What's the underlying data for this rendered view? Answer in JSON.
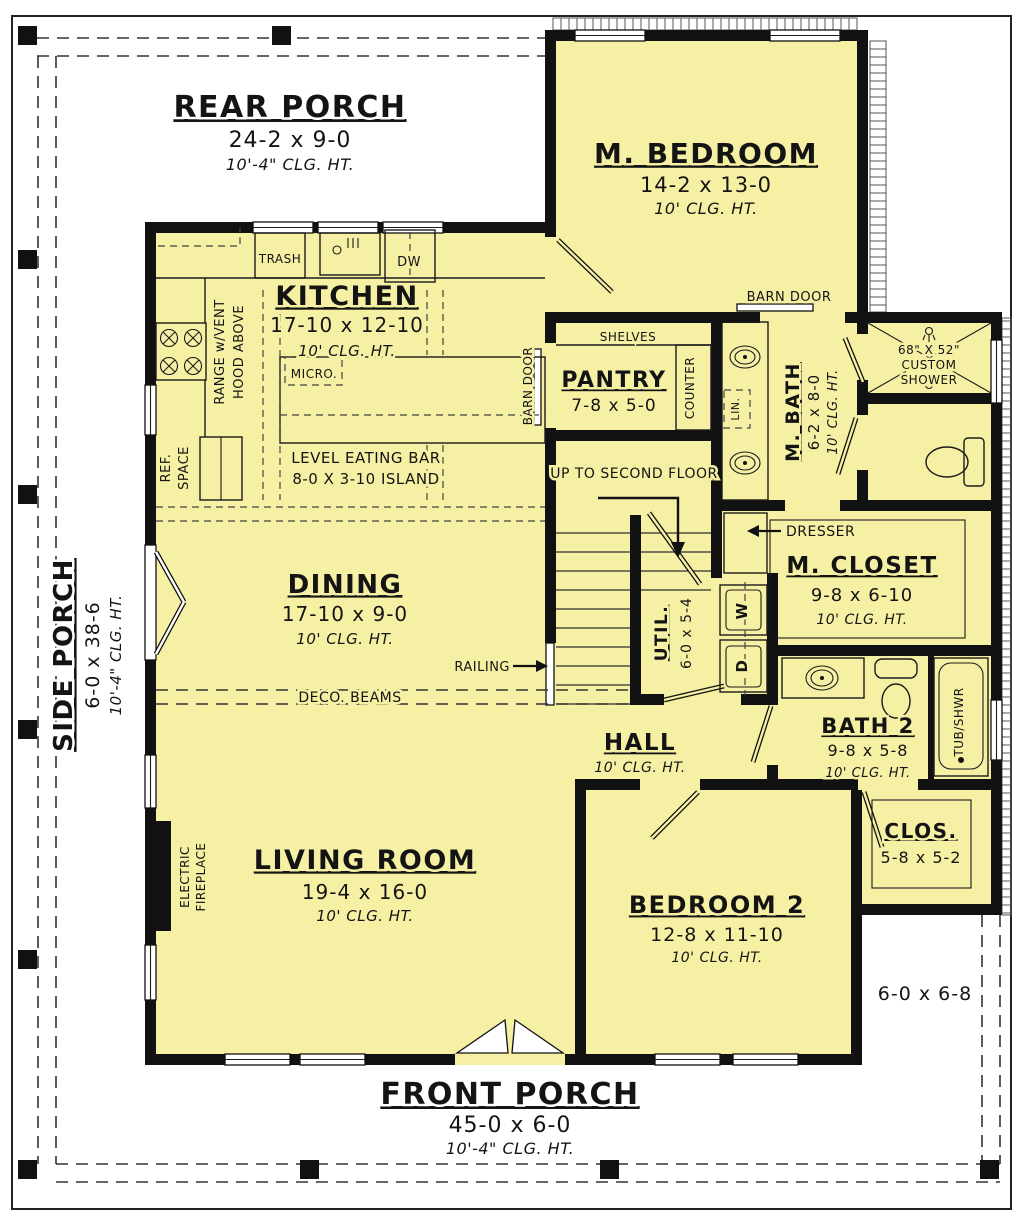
{
  "colors": {
    "floor": "#f5f0a4",
    "wall": "#111111",
    "porch": "#ffffff"
  },
  "rooms": {
    "rear_porch": {
      "name": "REAR PORCH",
      "dims": "24-2 x 9-0",
      "clg": "10'-4\" CLG. HT."
    },
    "m_bedroom": {
      "name": "M. BEDROOM",
      "dims": "14-2 x 13-0",
      "clg": "10' CLG. HT."
    },
    "kitchen": {
      "name": "KITCHEN",
      "dims": "17-10 x 12-10",
      "clg": "10' CLG. HT."
    },
    "pantry": {
      "name": "PANTRY",
      "dims": "7-8 x 5-0"
    },
    "m_bath": {
      "name": "M. BATH",
      "dims": "6-2 x 8-0",
      "clg": "10' CLG. HT."
    },
    "m_closet": {
      "name": "M. CLOSET",
      "dims": "9-8 x 6-10",
      "clg": "10' CLG. HT."
    },
    "dining": {
      "name": "DINING",
      "dims": "17-10 x 9-0",
      "clg": "10' CLG. HT."
    },
    "util": {
      "name": "UTIL.",
      "dims": "6-0 x 5-4"
    },
    "hall": {
      "name": "HALL",
      "clg": "10' CLG. HT."
    },
    "bath2": {
      "name": "BATH 2",
      "dims": "9-8 x 5-8",
      "clg": "10' CLG. HT."
    },
    "living": {
      "name": "LIVING ROOM",
      "dims": "19-4 x 16-0",
      "clg": "10' CLG. HT."
    },
    "bedroom2": {
      "name": "BEDROOM 2",
      "dims": "12-8 x 11-10",
      "clg": "10' CLG. HT."
    },
    "clos2": {
      "name": "CLOS.",
      "dims": "5-8 x 5-2"
    },
    "front_porch": {
      "name": "FRONT PORCH",
      "dims": "45-0 x 6-0",
      "clg": "10'-4\" CLG. HT."
    },
    "side_porch": {
      "name": "SIDE PORCH",
      "dims": "6-0 x 38-6",
      "clg": "10'-4\" CLG. HT."
    },
    "nook": {
      "dims": "6-0 x 6-8"
    }
  },
  "annotations": {
    "trash": "TRASH",
    "dw": "DW",
    "micro": "MICRO.",
    "range_line1": "RANGE w/VENT",
    "range_line2": "HOOD ABOVE",
    "ref_line1": "REF.",
    "ref_line2": "SPACE",
    "eating_bar": "LEVEL EATING BAR",
    "island": "8-0 X 3-10 ISLAND",
    "shelves": "SHELVES",
    "counter": "COUNTER",
    "barn_door_side": "BARN DOOR",
    "barn_door_top": "BARN DOOR",
    "lin": "LIN.",
    "shower_line1": "68\" X 52\"",
    "shower_line2": "CUSTOM",
    "shower_line3": "SHOWER",
    "stairs": "UP TO SECOND FLOOR",
    "dresser": "DRESSER",
    "railing": "RAILING",
    "deco_beams": "DECO. BEAMS",
    "washer": "W",
    "dryer": "D",
    "tub": "TUB/SHWR",
    "fireplace_line1": "ELECTRIC",
    "fireplace_line2": "FIREPLACE"
  }
}
